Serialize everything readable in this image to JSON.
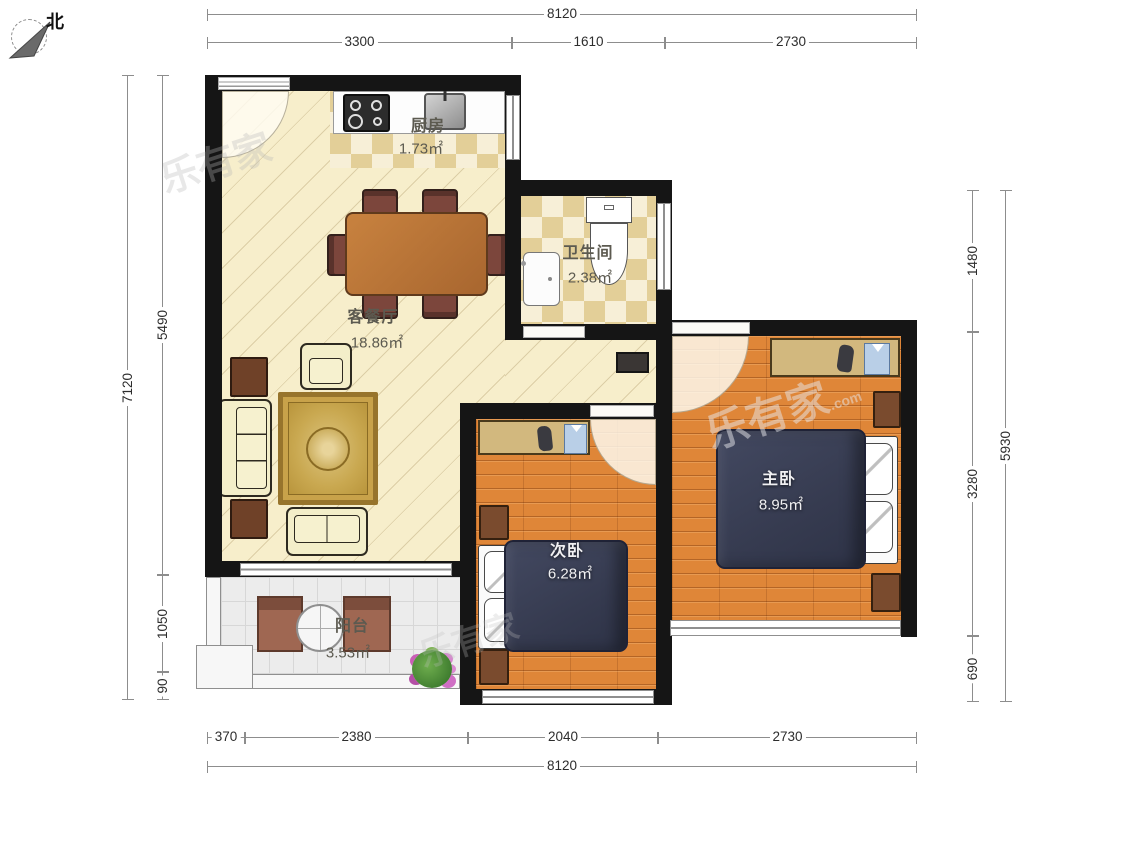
{
  "compass": {
    "label": "北"
  },
  "watermark": {
    "text": "乐有家",
    "suffix": ".com"
  },
  "dimensions": {
    "top": {
      "total": "8120",
      "segments": [
        "3300",
        "1610",
        "2730"
      ]
    },
    "bottom": {
      "total": "8120",
      "segments": [
        "370",
        "2380",
        "2040",
        "2730"
      ]
    },
    "left": {
      "total": "7120",
      "segments": [
        "5490",
        "1050",
        "90"
      ]
    },
    "right": {
      "total": "5930",
      "segments": [
        "1480",
        "3280",
        "690"
      ]
    }
  },
  "rooms": {
    "kitchen": {
      "name": "厨房",
      "area": "1.73㎡"
    },
    "bathroom": {
      "name": "卫生间",
      "area": "2.38㎡"
    },
    "living": {
      "name": "客餐厅",
      "area": "18.86㎡"
    },
    "master": {
      "name": "主卧",
      "area": "8.95㎡"
    },
    "second": {
      "name": "次卧",
      "area": "6.28㎡"
    },
    "balcony": {
      "name": "阳台",
      "area": "3.53㎡"
    }
  },
  "colors": {
    "wall": "#151515",
    "living_floor": "#f7eecb",
    "tile_floor": "#eedfae",
    "wood_floor": "#df8638",
    "balcony_floor": "#ececec",
    "bed": "#363b50",
    "dining_table": "#b5703b"
  }
}
